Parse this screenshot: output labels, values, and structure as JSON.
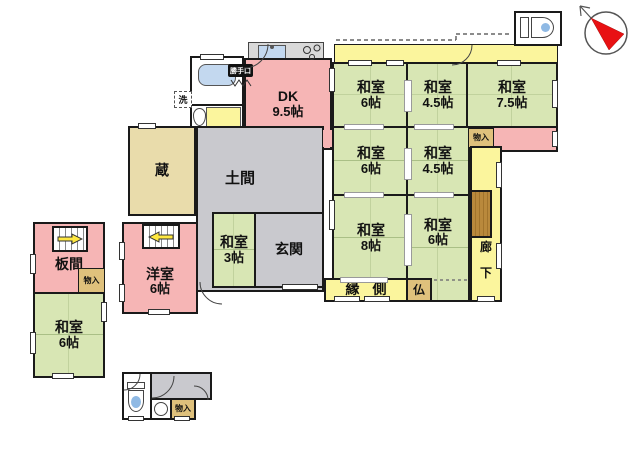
{
  "meta": {
    "type": "japanese-floor-plan"
  },
  "palette": {
    "tatami_green": "#d8e6b4",
    "room_pink": "#f6b5b5",
    "corridor_yellow": "#fbf59d",
    "earth_gray": "#c9c9ce",
    "kura_beige": "#e9dcab",
    "closet_tan": "#dfc17c",
    "wood_brown": "#b9893c",
    "wall_black": "#1a1a1a",
    "compass_red": "#e81113",
    "water_blue": "#a9c9e8"
  },
  "rooms": {
    "dk": {
      "name": "DK",
      "size": "9.5帖"
    },
    "kura": {
      "name": "蔵"
    },
    "doma": {
      "name": "土間"
    },
    "genkan": {
      "name": "玄関"
    },
    "washitsu3": {
      "name": "和室",
      "size": "3帖"
    },
    "washitsu6_ne": {
      "name": "和室",
      "size": "6帖"
    },
    "washitsu45_n": {
      "name": "和室",
      "size": "4.5帖"
    },
    "washitsu75": {
      "name": "和室",
      "size": "7.5帖"
    },
    "washitsu6_mid": {
      "name": "和室",
      "size": "6帖"
    },
    "washitsu45_mid": {
      "name": "和室",
      "size": "4.5帖"
    },
    "washitsu8": {
      "name": "和室",
      "size": "8帖"
    },
    "washitsu6_s": {
      "name": "和室",
      "size": "6帖"
    },
    "engawa": {
      "name": "縁側"
    },
    "rouka": {
      "char1": "廊",
      "char2": "下"
    },
    "butsudan": {
      "name": "仏"
    },
    "itanoma": {
      "name": "板間"
    },
    "youshitsu": {
      "name": "洋室",
      "size": "6帖"
    },
    "washitsu6_w": {
      "name": "和室",
      "size": "6帖"
    }
  },
  "labels": {
    "monoire": "物入",
    "sen": "洗",
    "rei": "冷",
    "katteguchi": "勝手口"
  }
}
